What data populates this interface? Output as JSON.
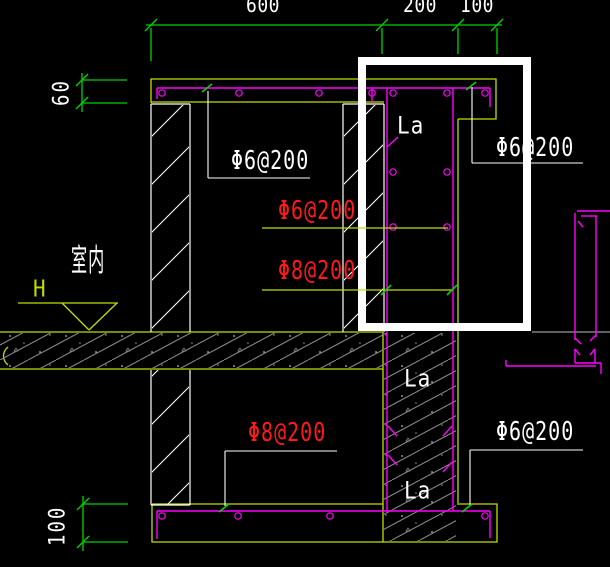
{
  "dimensions": {
    "top_600": "600",
    "top_200": "200",
    "top_100": "100",
    "left_60": "60",
    "left_100": "100"
  },
  "labels": {
    "interior": "室内",
    "elevation": "H",
    "anchorage_length": "La",
    "slab_top_rebar": "Φ6@200",
    "parapet_outer_rebar": "Φ6@200",
    "wall_horizontal_rebar": "Φ6@200",
    "wall_vertical_rebar": "Φ8@200",
    "bottom_slab_main_rebar": "Φ8@200",
    "bottom_slab_edge_rebar": "Φ6@200"
  },
  "colors": {
    "background": "#000000",
    "dimension_green": "#00d400",
    "outline_chartreuse": "#c3dc00",
    "rebar_magenta": "#ff00ff",
    "label_red": "#ff1a1a",
    "label_white": "#ffffff",
    "concrete_hatch_gray": "#8a8a8a",
    "floor_line_gray": "#9a9a9a",
    "highlight_box_white": "#ffffff"
  }
}
